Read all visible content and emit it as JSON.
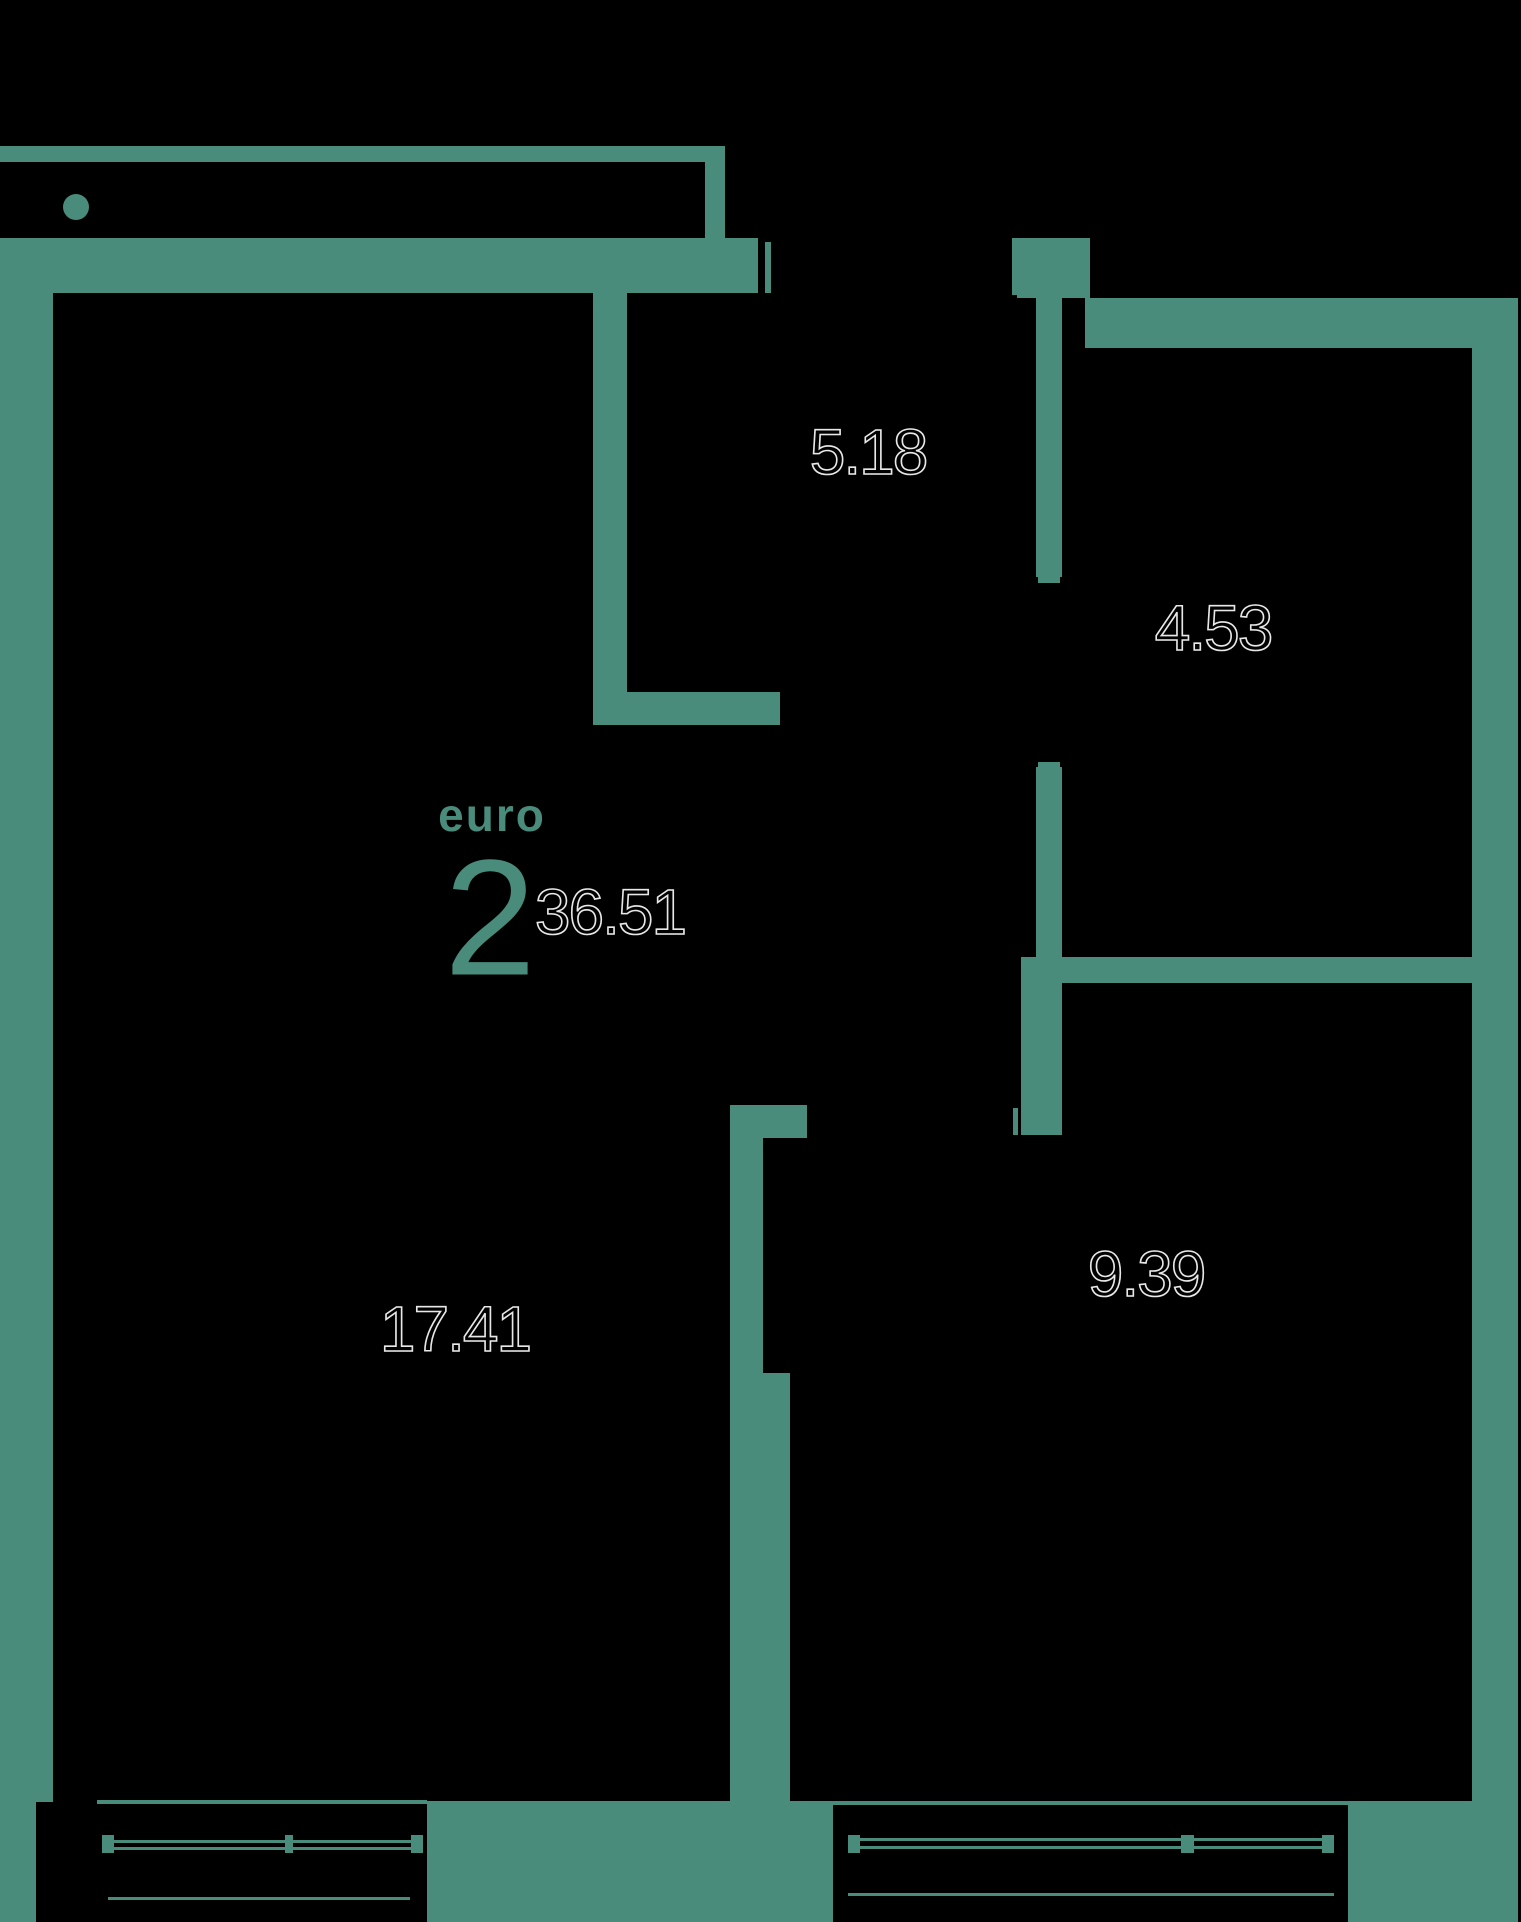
{
  "unit": {
    "type_label": "euro",
    "rooms_count": "2",
    "total_area": "36.51"
  },
  "areas": {
    "hallway": "5.18",
    "bathroom": "4.53",
    "bedroom": "9.39",
    "living_room": "17.41"
  },
  "colors": {
    "wall": "#4a8c7b",
    "background": "#000000",
    "area_label_fill": "#000000",
    "area_label_outline": "#e8e8e8"
  }
}
